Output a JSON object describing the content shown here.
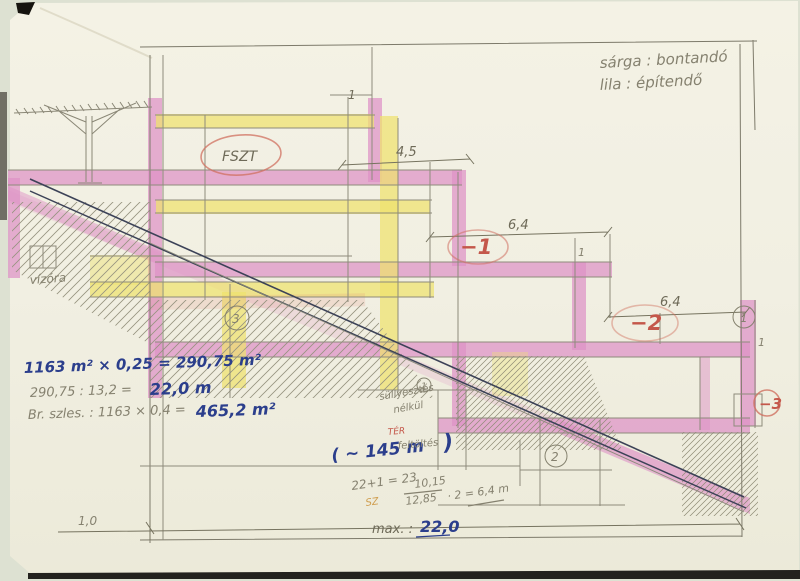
{
  "legend": {
    "line1": "sárga : bontandó",
    "line2": "lila : építendő"
  },
  "levels": {
    "ground": "FSZT",
    "minus1": "−1",
    "minus2": "−2",
    "minus3": "−3"
  },
  "dimensions": {
    "d45": "4,5",
    "d64a": "6,4",
    "d64b": "6,4",
    "one_top": "1",
    "one_mid": "1",
    "one_right": "1",
    "scale": "1,0"
  },
  "markers": {
    "circle1_mid": "1",
    "circle1_right": "1",
    "circle2": "2",
    "circle3": "3"
  },
  "notes": {
    "vizora": "vízóra",
    "sullyesztes": "süllyesztés",
    "nelkul": "nélkül",
    "ter": "TÉR",
    "sz": "SZ"
  },
  "calc": {
    "line1": "1163 m² × 0,25 = 290,75 m²",
    "line2_lhs": "290,75 : 13,2 =",
    "line2_rhs": "22,0 m",
    "line3_lhs": "Br. szles. : 1163 × 0,4 =",
    "line3_rhs": "465,2 m²",
    "approx_lhs": "( ~ 145 m",
    "approx_mid": "feltöltés",
    "approx_rhs": ")",
    "sum": "22+1 = 23",
    "frac_num": "10,15",
    "frac_den": "12,85",
    "frac_result": "· 2 = 6,4 m",
    "max_lhs": "max. :",
    "max_rhs": "22,0"
  },
  "colors": {
    "yellow_highlight": "#eee26e",
    "pink_highlight": "#de92c6",
    "red_pencil": "#c4574a",
    "blue_pen": "#2b3e8c",
    "graphite": "#85816f"
  }
}
